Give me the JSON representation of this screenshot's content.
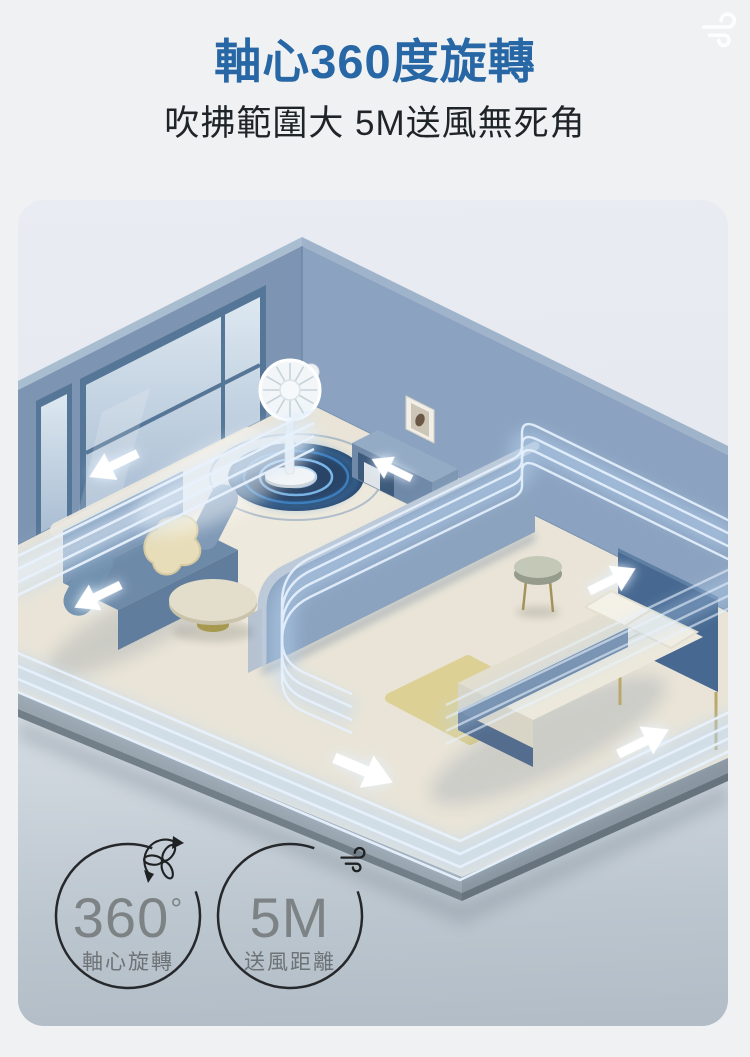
{
  "page": {
    "background_color": "#f0f1f3"
  },
  "corner_icon": {
    "name": "wind-icon",
    "color": "#ffffff"
  },
  "header": {
    "title": "軸心360度旋轉",
    "title_color": "#2767a5",
    "subtitle": "吹拂範圍大 5M送風無死角",
    "subtitle_color": "#1f2428"
  },
  "illustration": {
    "type": "isometric-room-render",
    "elements": [
      "standing-fan",
      "rotation-glow-rings",
      "windows",
      "sofa",
      "blanket",
      "coffee-table",
      "sideboard",
      "picture-frame",
      "partition-wall",
      "bed",
      "pillows",
      "bedside-table",
      "yellow-rug",
      "airflow-ribbons",
      "airflow-arrows"
    ],
    "wall_color": "#869eba",
    "floor_color": "#e9e4d7",
    "airflow_color": "#a9cdf2"
  },
  "badges": [
    {
      "value": "360",
      "sup": "°",
      "label": "軸心旋轉",
      "icon": "rotating-fan-blades-icon"
    },
    {
      "value": "5M",
      "sup": "",
      "label": "送風距離",
      "icon": "wind-icon"
    }
  ],
  "badge_style": {
    "ring_color": "#26282b",
    "value_color": "#7d8285",
    "label_color": "#6d7376"
  }
}
